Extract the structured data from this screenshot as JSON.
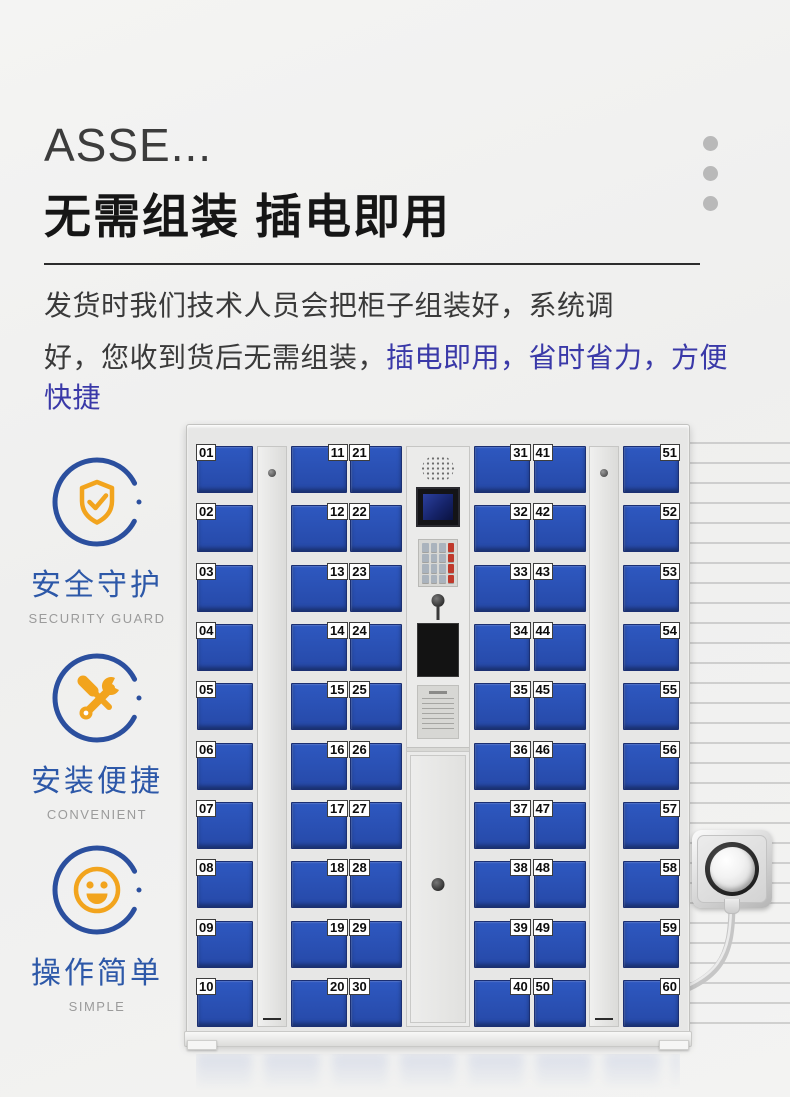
{
  "header": {
    "title_truncated": "ASSE...",
    "headline": "无需组装  插电即用",
    "paragraph_line1": "发货时我们技术人员会把柜子组装好，系统调",
    "paragraph_line2_prefix": "好，您收到货后无需组装，",
    "paragraph_line2_highlight": "插电即用，省时省力，方便快捷",
    "highlight_color": "#3a39a8"
  },
  "features": [
    {
      "icon": "shield-check-icon",
      "label": "安全守护",
      "sublabel": "SECURITY GUARD"
    },
    {
      "icon": "wrench-screwdriver-icon",
      "label": "安装便捷",
      "sublabel": "CONVENIENT"
    },
    {
      "icon": "smiley-icon",
      "label": "操作简单",
      "sublabel": "SIMPLE"
    }
  ],
  "locker": {
    "door_color": "#2a50b4",
    "columns": [
      {
        "label_side": "left",
        "numbers": [
          "01",
          "02",
          "03",
          "04",
          "05",
          "06",
          "07",
          "08",
          "09",
          "10"
        ]
      },
      {
        "label_side": "right",
        "numbers": [
          "11",
          "12",
          "13",
          "14",
          "15",
          "16",
          "17",
          "18",
          "19",
          "20"
        ]
      },
      {
        "label_side": "left",
        "numbers": [
          "21",
          "22",
          "23",
          "24",
          "25",
          "26",
          "27",
          "28",
          "29",
          "30"
        ]
      },
      {
        "label_side": "right",
        "numbers": [
          "31",
          "32",
          "33",
          "34",
          "35",
          "36",
          "37",
          "38",
          "39",
          "40"
        ]
      },
      {
        "label_side": "left",
        "numbers": [
          "41",
          "42",
          "43",
          "44",
          "45",
          "46",
          "47",
          "48",
          "49",
          "50"
        ]
      },
      {
        "label_side": "right",
        "numbers": [
          "51",
          "52",
          "53",
          "54",
          "55",
          "56",
          "57",
          "58",
          "59",
          "60"
        ]
      }
    ]
  },
  "colors": {
    "accent_blue": "#2d58a8",
    "icon_orange": "#f2a41d",
    "door_blue": "#2a50b4",
    "headline_text": "#161616"
  }
}
